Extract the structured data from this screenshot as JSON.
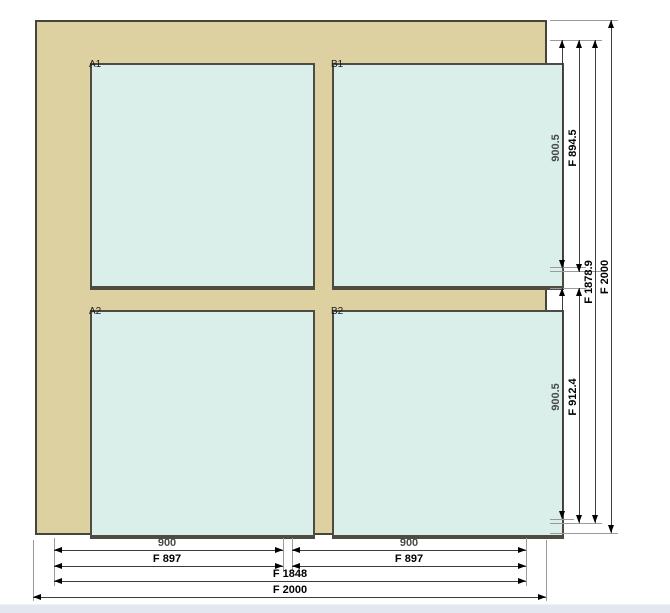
{
  "window_drawing": {
    "pane_labels": {
      "a1": "A1",
      "b1": "B1",
      "a2": "A2",
      "b2": "B2"
    },
    "dims_right": {
      "sash_top_nominal": "900.5",
      "sash_top_frame": "F 894.5",
      "sash_bottom_nominal": "900.5",
      "sash_bottom_frame": "F 912.4",
      "inner_height": "F 1878.9",
      "total_height": "F 2000"
    },
    "dims_bottom": {
      "left_nominal": "900",
      "left_frame": "F 897",
      "right_nominal": "900",
      "right_frame": "F 897",
      "inner_width": "F 1848",
      "total_width": "F 2000"
    },
    "colors": {
      "frame_fill": "#ddd1a2",
      "frame_border": "#45453a",
      "glass_fill": "#daeeea",
      "glass_border": "#4c4c42",
      "dimension_line": "#3c3c3c",
      "extension_line": "#9a9a9a",
      "dimension_text": "#000000",
      "nominal_text": "#4a4a4a",
      "background": "#ffffff",
      "footer_strip": "#e2e7f0"
    }
  }
}
